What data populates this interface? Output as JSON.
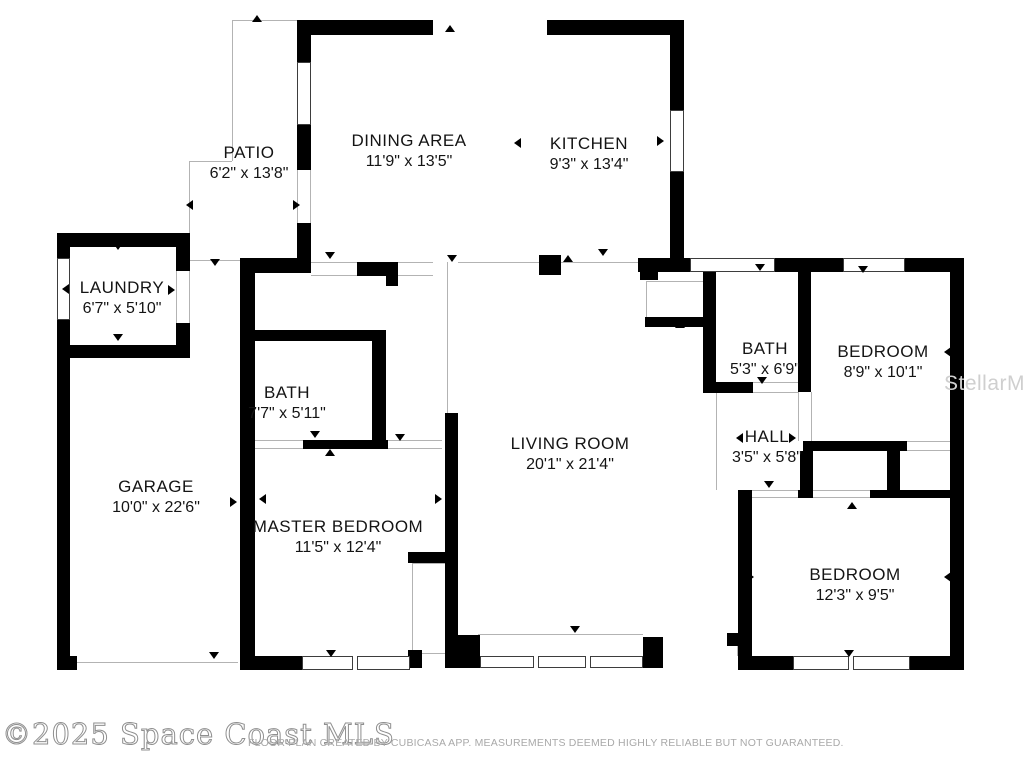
{
  "floor_plan": {
    "colors": {
      "wall": "#000000",
      "background": "#ffffff",
      "label_text": "#141414",
      "thin_line": "#b3b3b3",
      "watermark_gray": "#a9a9a9",
      "stellar_gray": "#cfcfcf"
    },
    "rooms": {
      "patio": {
        "name": "PATIO",
        "dims": "6'2\" x 13'8\"",
        "x": 249,
        "y": 143
      },
      "dining": {
        "name": "DINING AREA",
        "dims": "11'9\" x 13'5\"",
        "x": 409,
        "y": 131
      },
      "kitchen": {
        "name": "KITCHEN",
        "dims": "9'3\" x 13'4\"",
        "x": 589,
        "y": 134
      },
      "laundry": {
        "name": "LAUNDRY",
        "dims": "6'7\" x 5'10\"",
        "x": 122,
        "y": 278
      },
      "bath1": {
        "name": "BATH",
        "dims": "7'7\" x 5'11\"",
        "x": 287,
        "y": 383
      },
      "garage": {
        "name": "GARAGE",
        "dims": "10'0\" x 22'6\"",
        "x": 156,
        "y": 477
      },
      "master": {
        "name": "MASTER BEDROOM",
        "dims": "11'5\" x 12'4\"",
        "x": 338,
        "y": 517
      },
      "living": {
        "name": "LIVING ROOM",
        "dims": "20'1\" x 21'4\"",
        "x": 570,
        "y": 434
      },
      "bath2": {
        "name": "BATH",
        "dims": "5'3\" x 6'9\"",
        "x": 765,
        "y": 339
      },
      "bedroom1": {
        "name": "BEDROOM",
        "dims": "8'9\" x 10'1\"",
        "x": 883,
        "y": 342
      },
      "hall": {
        "name": "HALL",
        "dims": "3'5\" x 5'8\"",
        "x": 767,
        "y": 427
      },
      "bedroom2": {
        "name": "BEDROOM",
        "dims": "12'3\" x 9'5\"",
        "x": 855,
        "y": 565
      }
    },
    "watermarks": {
      "copyright": "©2025 Space Coast MLS",
      "disclaimer": "FLOOR PLAN CREATED BY CUBICASA APP. MEASUREMENTS DEEMED HIGHLY RELIABLE BUT NOT GUARANTEED.",
      "stellar": "StellarMLS"
    },
    "geometry": {
      "walls": [
        [
          297,
          20,
          136,
          15
        ],
        [
          547,
          20,
          137,
          15
        ],
        [
          670,
          20,
          14,
          90
        ],
        [
          670,
          172,
          14,
          90
        ],
        [
          297,
          35,
          14,
          27
        ],
        [
          297,
          125,
          14,
          45
        ],
        [
          297,
          223,
          14,
          39
        ],
        [
          638,
          258,
          52,
          14
        ],
        [
          775,
          258,
          68,
          14
        ],
        [
          905,
          258,
          59,
          14
        ],
        [
          950,
          258,
          14,
          412
        ],
        [
          240,
          258,
          15,
          412
        ],
        [
          240,
          258,
          71,
          15
        ],
        [
          357,
          262,
          41,
          14
        ],
        [
          386,
          276,
          12,
          10
        ],
        [
          240,
          330,
          146,
          11
        ],
        [
          372,
          341,
          14,
          99
        ],
        [
          303,
          440,
          85,
          9
        ],
        [
          245,
          438,
          8,
          10
        ],
        [
          445,
          413,
          13,
          255
        ],
        [
          408,
          552,
          37,
          11
        ],
        [
          408,
          650,
          14,
          18
        ],
        [
          240,
          656,
          62,
          14
        ],
        [
          448,
          635,
          32,
          33
        ],
        [
          643,
          637,
          20,
          31
        ],
        [
          640,
          267,
          18,
          13
        ],
        [
          645,
          317,
          58,
          10
        ],
        [
          703,
          267,
          13,
          126
        ],
        [
          703,
          382,
          50,
          11
        ],
        [
          798,
          267,
          13,
          125
        ],
        [
          803,
          441,
          104,
          10
        ],
        [
          800,
          451,
          13,
          47
        ],
        [
          887,
          450,
          13,
          42
        ],
        [
          738,
          490,
          14,
          180
        ],
        [
          727,
          633,
          11,
          13
        ],
        [
          798,
          490,
          15,
          8
        ],
        [
          870,
          490,
          94,
          8
        ],
        [
          738,
          656,
          55,
          14
        ],
        [
          910,
          656,
          54,
          14
        ],
        [
          57,
          233,
          133,
          14
        ],
        [
          57,
          233,
          13,
          27
        ],
        [
          57,
          318,
          13,
          352
        ],
        [
          57,
          345,
          133,
          13
        ],
        [
          176,
          233,
          14,
          38
        ],
        [
          176,
          323,
          14,
          35
        ],
        [
          57,
          656,
          20,
          14
        ],
        [
          539,
          255,
          22,
          20
        ]
      ],
      "windows": [
        {
          "x": 297,
          "y": 62,
          "w": 14,
          "h": 63,
          "m": []
        },
        {
          "x": 670,
          "y": 110,
          "w": 14,
          "h": 62,
          "m": []
        },
        {
          "x": 57,
          "y": 258,
          "w": 13,
          "h": 62,
          "m": []
        },
        {
          "x": 690,
          "y": 258,
          "w": 85,
          "h": 14,
          "m": []
        },
        {
          "x": 843,
          "y": 258,
          "w": 62,
          "h": 14,
          "m": []
        },
        {
          "x": 302,
          "y": 656,
          "w": 108,
          "h": 14,
          "m": [
            352
          ]
        },
        {
          "x": 480,
          "y": 656,
          "w": 163,
          "h": 12,
          "m": [
            533,
            585
          ]
        },
        {
          "x": 793,
          "y": 656,
          "w": 117,
          "h": 14,
          "m": [
            848
          ]
        }
      ],
      "thin_lines": [
        [
          232,
          20,
          65,
          1
        ],
        [
          232,
          20,
          1,
          141
        ],
        [
          189,
          161,
          43,
          1
        ],
        [
          189,
          161,
          1,
          72
        ],
        [
          297,
          170,
          1,
          53
        ],
        [
          310,
          170,
          1,
          53
        ],
        [
          311,
          262,
          46,
          1
        ],
        [
          311,
          275,
          46,
          1
        ],
        [
          398,
          262,
          35,
          1
        ],
        [
          398,
          275,
          35,
          1
        ],
        [
          447,
          262,
          1,
          178
        ],
        [
          458,
          262,
          81,
          1
        ],
        [
          561,
          262,
          77,
          1
        ],
        [
          176,
          271,
          1,
          52
        ],
        [
          189,
          271,
          1,
          52
        ],
        [
          190,
          260,
          50,
          1
        ],
        [
          253,
          440,
          50,
          1
        ],
        [
          253,
          448,
          50,
          1
        ],
        [
          388,
          440,
          54,
          1
        ],
        [
          388,
          448,
          54,
          1
        ],
        [
          412,
          563,
          1,
          87
        ],
        [
          412,
          563,
          33,
          1
        ],
        [
          422,
          653,
          23,
          1
        ],
        [
          646,
          281,
          1,
          36
        ],
        [
          646,
          281,
          57,
          1
        ],
        [
          753,
          382,
          45,
          1
        ],
        [
          753,
          392,
          45,
          1
        ],
        [
          716,
          393,
          1,
          97
        ],
        [
          798,
          392,
          1,
          49
        ],
        [
          811,
          392,
          1,
          49
        ],
        [
          907,
          441,
          43,
          1
        ],
        [
          907,
          450,
          43,
          1
        ],
        [
          752,
          490,
          46,
          1
        ],
        [
          752,
          497,
          46,
          1
        ],
        [
          813,
          490,
          57,
          1
        ],
        [
          813,
          497,
          57,
          1
        ],
        [
          478,
          634,
          165,
          1
        ],
        [
          737,
          634,
          1,
          22
        ],
        [
          72,
          662,
          166,
          1
        ]
      ],
      "markers": [
        {
          "x": 252,
          "y": 12,
          "d": "up"
        },
        {
          "x": 445,
          "y": 22,
          "d": "up"
        },
        {
          "x": 597,
          "y": 22,
          "d": "up"
        },
        {
          "x": 325,
          "y": 446,
          "d": "up"
        },
        {
          "x": 675,
          "y": 318,
          "d": "up"
        },
        {
          "x": 847,
          "y": 499,
          "d": "up"
        },
        {
          "x": 563,
          "y": 252,
          "d": "up"
        },
        {
          "x": 325,
          "y": 252,
          "d": "down"
        },
        {
          "x": 210,
          "y": 259,
          "d": "down"
        },
        {
          "x": 113,
          "y": 243,
          "d": "down"
        },
        {
          "x": 113,
          "y": 334,
          "d": "down"
        },
        {
          "x": 209,
          "y": 652,
          "d": "down"
        },
        {
          "x": 310,
          "y": 431,
          "d": "down"
        },
        {
          "x": 395,
          "y": 434,
          "d": "down"
        },
        {
          "x": 570,
          "y": 626,
          "d": "down"
        },
        {
          "x": 447,
          "y": 255,
          "d": "down"
        },
        {
          "x": 598,
          "y": 249,
          "d": "down"
        },
        {
          "x": 755,
          "y": 264,
          "d": "down"
        },
        {
          "x": 858,
          "y": 266,
          "d": "down"
        },
        {
          "x": 757,
          "y": 377,
          "d": "down"
        },
        {
          "x": 764,
          "y": 481,
          "d": "down"
        },
        {
          "x": 844,
          "y": 650,
          "d": "down"
        },
        {
          "x": 326,
          "y": 650,
          "d": "down"
        },
        {
          "x": 183,
          "y": 200,
          "d": "left"
        },
        {
          "x": 59,
          "y": 284,
          "d": "left"
        },
        {
          "x": 59,
          "y": 497,
          "d": "left"
        },
        {
          "x": 256,
          "y": 494,
          "d": "left"
        },
        {
          "x": 733,
          "y": 433,
          "d": "left"
        },
        {
          "x": 941,
          "y": 347,
          "d": "left"
        },
        {
          "x": 941,
          "y": 572,
          "d": "left"
        },
        {
          "x": 511,
          "y": 138,
          "d": "left"
        },
        {
          "x": 293,
          "y": 200,
          "d": "right"
        },
        {
          "x": 168,
          "y": 285,
          "d": "right"
        },
        {
          "x": 230,
          "y": 497,
          "d": "right"
        },
        {
          "x": 435,
          "y": 494,
          "d": "right"
        },
        {
          "x": 789,
          "y": 433,
          "d": "right"
        },
        {
          "x": 657,
          "y": 136,
          "d": "right"
        },
        {
          "x": 747,
          "y": 572,
          "d": "right"
        }
      ]
    }
  }
}
